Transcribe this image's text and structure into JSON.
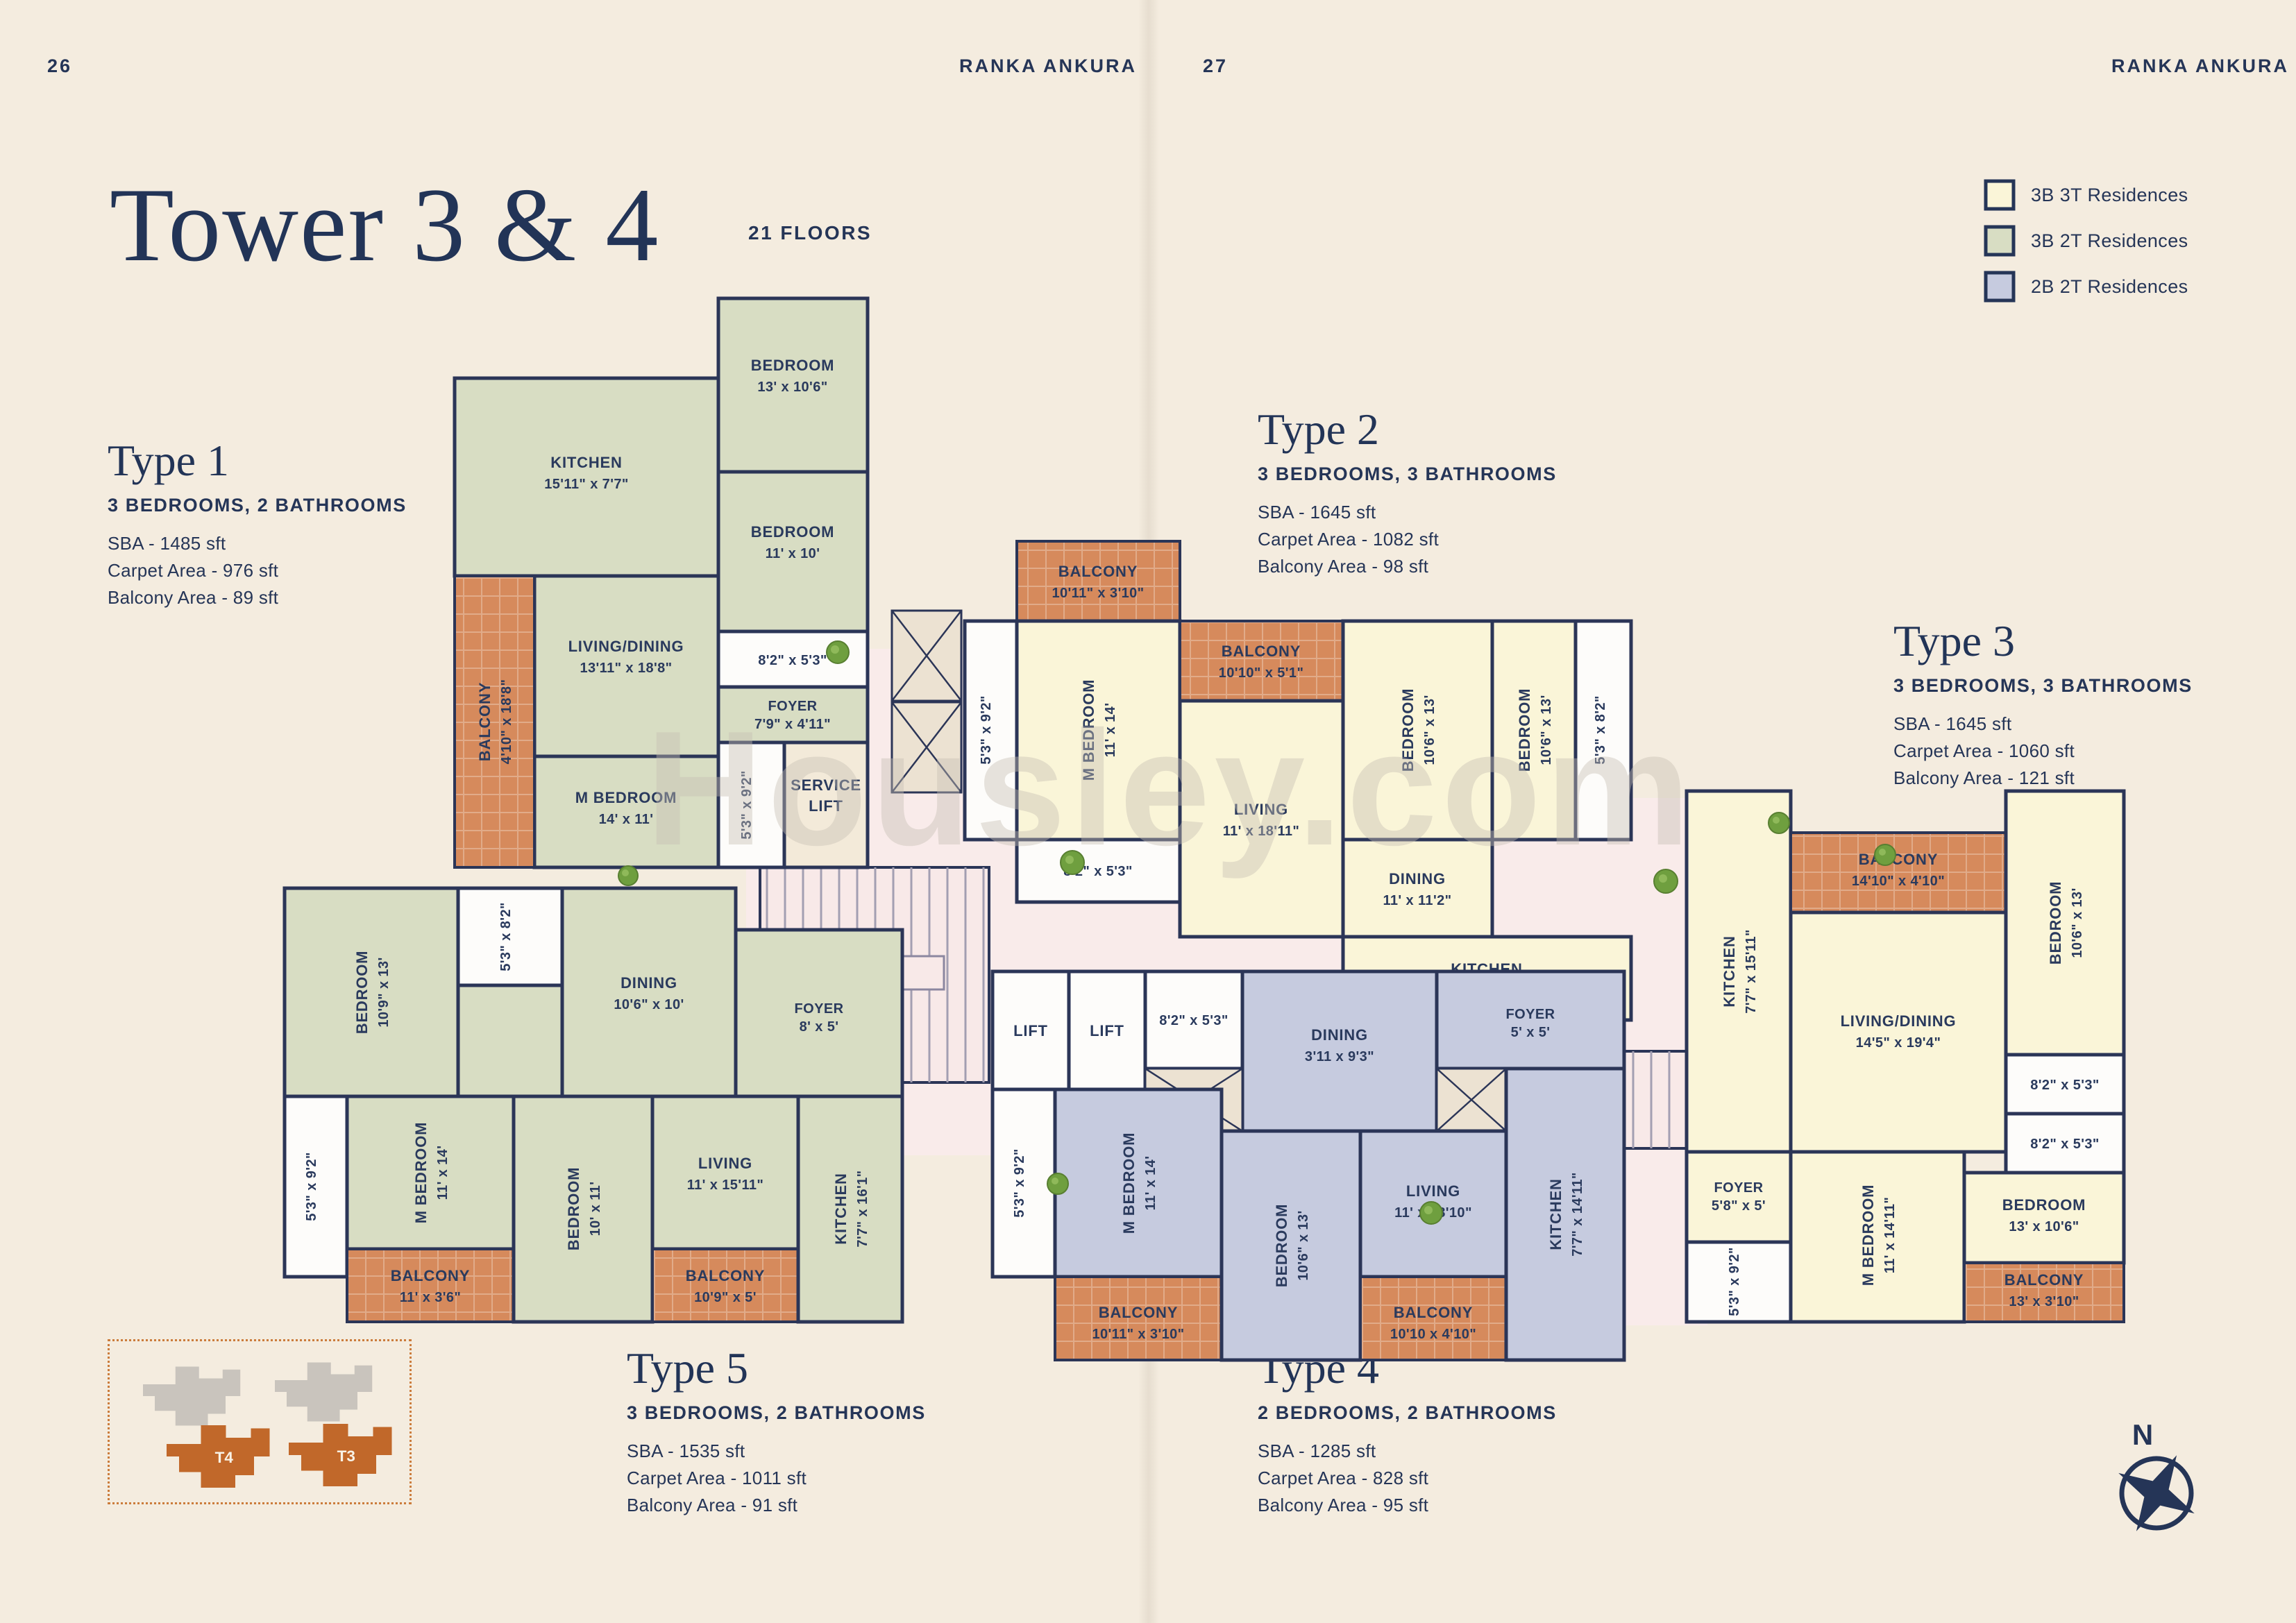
{
  "page": {
    "left_number": "26",
    "right_number": "27",
    "brand": "RANKA ANKURA",
    "title": "Tower 3 & 4",
    "floors_note": "21 FLOORS",
    "watermark": "Housley.com"
  },
  "palette": {
    "background": "#f4ecdf",
    "navy_wall_text": "#2b3557",
    "residence_3b3t": "#faf5d8",
    "residence_3b2t": "#d8ddc3",
    "residence_2b2t": "#c6cbdf",
    "balcony": "#d68a5c",
    "corridor": "#f9ebea",
    "keymap_tower": "#c1682a"
  },
  "legend": {
    "items": [
      {
        "label": "3B 3T Residences",
        "color": "#faf5d8"
      },
      {
        "label": "3B 2T Residences",
        "color": "#d8ddc3"
      },
      {
        "label": "2B 2T Residences",
        "color": "#c6cbdf"
      }
    ]
  },
  "types": [
    {
      "name": "Type 1",
      "config": "3 BEDROOMS, 2 BATHROOMS",
      "sba": "SBA - 1485 sft",
      "carpet": "Carpet Area - 976 sft",
      "balcony": "Balcony Area - 89 sft"
    },
    {
      "name": "Type 2",
      "config": "3 BEDROOMS, 3 BATHROOMS",
      "sba": "SBA - 1645 sft",
      "carpet": "Carpet Area - 1082 sft",
      "balcony": "Balcony Area - 98 sft"
    },
    {
      "name": "Type 3",
      "config": "3 BEDROOMS, 3 BATHROOMS",
      "sba": "SBA - 1645 sft",
      "carpet": "Carpet Area - 1060 sft",
      "balcony": "Balcony Area - 121 sft"
    },
    {
      "name": "Type 4",
      "config": "2 BEDROOMS, 2 BATHROOMS",
      "sba": "SBA - 1285 sft",
      "carpet": "Carpet Area - 828 sft",
      "balcony": "Balcony Area - 95 sft"
    },
    {
      "name": "Type 5",
      "config": "3 BEDROOMS, 2 BATHROOMS",
      "sba": "SBA - 1535 sft",
      "carpet": "Carpet Area - 1011 sft",
      "balcony": "Balcony Area - 91 sft"
    }
  ],
  "plan": {
    "t1": {
      "rooms": [
        {
          "l1": "KITCHEN",
          "l2": "15'11\" x 7'7\""
        },
        {
          "l1": "BEDROOM",
          "l2": "13' x 10'6\""
        },
        {
          "l1": "BEDROOM",
          "l2": "11' x 10'"
        },
        {
          "l1": "8'2\" x 5'3\"",
          "l2": ""
        },
        {
          "l1": "FOYER",
          "l2": "7'9\" x 4'11\""
        },
        {
          "l1": "LIVING/DINING",
          "l2": "13'11\" x 18'8\""
        },
        {
          "l1": "M BEDROOM",
          "l2": "14' x 11'"
        },
        {
          "l1": "BALCONY",
          "l2": "4'10\" x 18'8\""
        },
        {
          "l1": "5'3\" x 9'2\"",
          "l2": ""
        },
        {
          "l1": "SERVICE",
          "l2": "LIFT"
        }
      ]
    },
    "t2": {
      "rooms": [
        {
          "l1": "5'3\" x 9'2\"",
          "l2": ""
        },
        {
          "l1": "BALCONY",
          "l2": "10'11\" x 3'10\""
        },
        {
          "l1": "M BEDROOM",
          "l2": "11' x 14'"
        },
        {
          "l1": "8'2\" x 5'3\"",
          "l2": ""
        },
        {
          "l1": "BALCONY",
          "l2": "10'10\" x 5'1\""
        },
        {
          "l1": "LIVING",
          "l2": "11' x 18'11\""
        },
        {
          "l1": "BEDROOM",
          "l2": "10'6\" x 13'"
        },
        {
          "l1": "DINING",
          "l2": "11' x 11'2\""
        },
        {
          "l1": "BEDROOM",
          "l2": "10'6\" x 13'"
        },
        {
          "l1": "5'3\" x 8'2\"",
          "l2": ""
        },
        {
          "l1": "KITCHEN",
          "l2": "16'3\" x 7'7\""
        }
      ]
    },
    "t3": {
      "rooms": [
        {
          "l1": "KITCHEN",
          "l2": "7'7\" x 15'11\""
        },
        {
          "l1": "BALCONY",
          "l2": "14'10\" x 4'10\""
        },
        {
          "l1": "BEDROOM",
          "l2": "10'6\" x 13'"
        },
        {
          "l1": "LIVING/DINING",
          "l2": "14'5\" x 19'4\""
        },
        {
          "l1": "FOYER",
          "l2": "5'8\" x 5'"
        },
        {
          "l1": "8'2\" x 5'3\"",
          "l2": ""
        },
        {
          "l1": "8'2\" x 5'3\"",
          "l2": ""
        },
        {
          "l1": "M BEDROOM",
          "l2": "11' x 14'11\""
        },
        {
          "l1": "5'3\" x 9'2\"",
          "l2": ""
        },
        {
          "l1": "BEDROOM",
          "l2": "13' x 10'6\""
        },
        {
          "l1": "BALCONY",
          "l2": "13' x 3'10\""
        }
      ]
    },
    "t4": {
      "rooms": [
        {
          "l1": "LIFT",
          "l2": ""
        },
        {
          "l1": "LIFT",
          "l2": ""
        },
        {
          "l1": "8'2\" x 5'3\"",
          "l2": ""
        },
        {
          "l1": "DINING",
          "l2": "3'11 x 9'3\""
        },
        {
          "l1": "FOYER",
          "l2": "5' x 5'"
        },
        {
          "l1": "5'3\" x 9'2\"",
          "l2": ""
        },
        {
          "l1": "M BEDROOM",
          "l2": "11' x 14'"
        },
        {
          "l1": "BALCONY",
          "l2": "10'11\" x 3'10\""
        },
        {
          "l1": "BEDROOM",
          "l2": "10'6\" x 13'"
        },
        {
          "l1": "LIVING",
          "l2": "11' x 18'10\""
        },
        {
          "l1": "BALCONY",
          "l2": "10'10 x 4'10\""
        },
        {
          "l1": "KITCHEN",
          "l2": "7'7\" x 14'11\""
        }
      ]
    },
    "t5": {
      "rooms": [
        {
          "l1": "BEDROOM",
          "l2": "10'9\" x 13'"
        },
        {
          "l1": "5'3\" x 8'2\"",
          "l2": ""
        },
        {
          "l1": "DINING",
          "l2": "10'6\" x 10'"
        },
        {
          "l1": "FOYER",
          "l2": "8' x 5'"
        },
        {
          "l1": "5'3\" x 9'2\"",
          "l2": ""
        },
        {
          "l1": "M BEDROOM",
          "l2": "11' x 14'"
        },
        {
          "l1": "BALCONY",
          "l2": "11' x 3'6\""
        },
        {
          "l1": "BEDROOM",
          "l2": "10' x 11'"
        },
        {
          "l1": "LIVING",
          "l2": "11' x 15'11\""
        },
        {
          "l1": "BALCONY",
          "l2": "10'9\" x 5'"
        },
        {
          "l1": "KITCHEN",
          "l2": "7'7\" x 16'1\""
        }
      ]
    }
  },
  "key_map": {
    "towers": [
      "T4",
      "T3"
    ]
  },
  "compass": {
    "label": "N"
  }
}
